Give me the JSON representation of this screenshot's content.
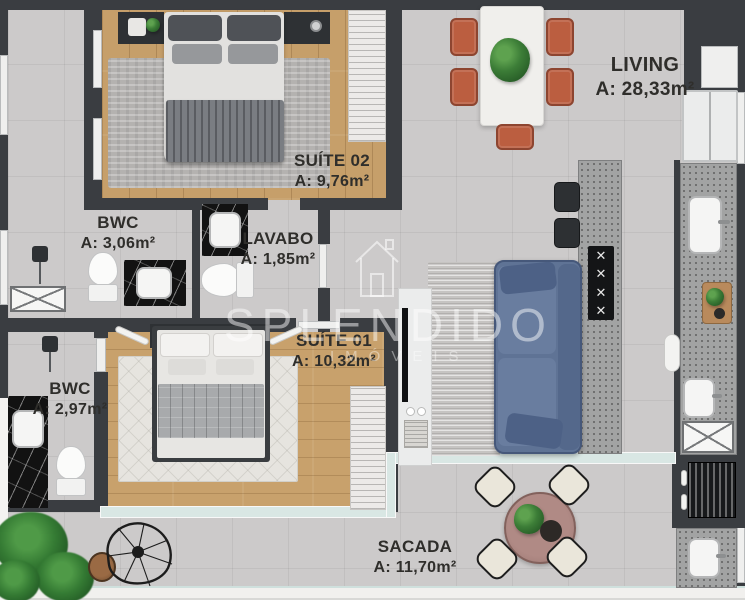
{
  "plan_title": "apartment-floor-plan",
  "rooms": {
    "living": {
      "name": "LIVING",
      "area": "A: 28,33m²"
    },
    "suite02": {
      "name": "SUÍTE 02",
      "area": "A: 9,76m²"
    },
    "bwc1": {
      "name": "BWC",
      "area": "A: 3,06m²"
    },
    "lavabo": {
      "name": "LAVABO",
      "area": "A: 1,85m²"
    },
    "suite01": {
      "name": "SUÍTE 01",
      "area": "A: 10,32m²"
    },
    "bwc2": {
      "name": "BWC",
      "area": "A: 2,97m²"
    },
    "sacada": {
      "name": "SACADA",
      "area": "A: 11,70m²"
    }
  },
  "watermark": {
    "brand": "SPLENDIDO",
    "tagline": "IMÓVEIS"
  },
  "colors": {
    "wall": "#3a3d41",
    "tile_floor": "#cccaca",
    "wood_floor": "#c69f6a",
    "granite_counter": "#a2a3a3",
    "terracotta_chairs": "#bb5e40",
    "sofa_blue": "#5f7395",
    "black_marble": "#121212",
    "glass": "#d9e7e4",
    "plant_green": "#3c7d37",
    "balcony_table": "#a5807c",
    "label_text": "#2f2e2b"
  }
}
